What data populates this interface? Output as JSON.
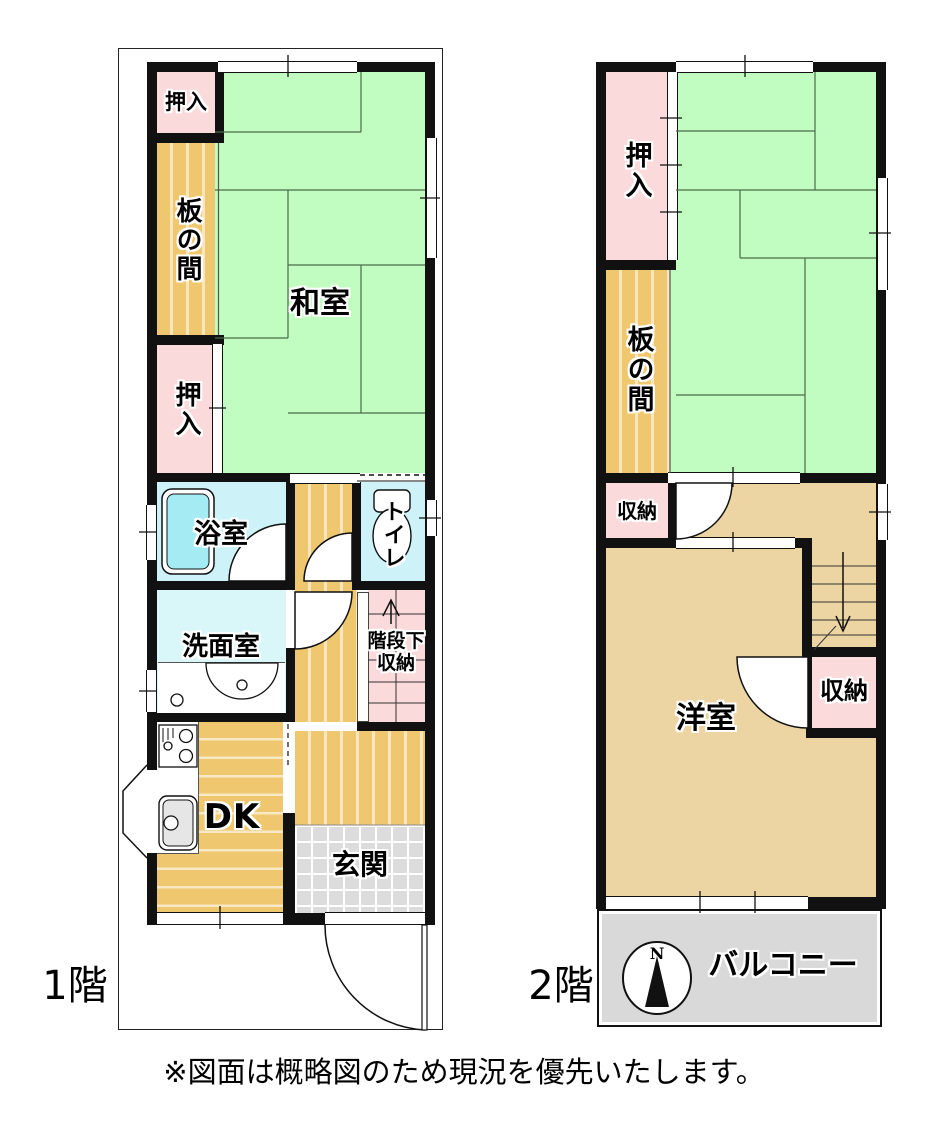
{
  "floor1": {
    "floor_label": "1階",
    "rooms": {
      "oshiire_top": "押入",
      "itanoma": "板の間",
      "washitsu": "和室",
      "oshiire_mid": "押入",
      "bathroom": "浴室",
      "toilet": "トイレ",
      "washroom": "洗面室",
      "understair_line1": "階段下",
      "understair_line2": "収納",
      "dk": "DK",
      "genkan": "玄関"
    }
  },
  "floor2": {
    "floor_label": "2階",
    "rooms": {
      "oshiire": "押入",
      "itanoma": "板の間",
      "storage_left": "収納",
      "storage_right": "収納",
      "youshitsu": "洋室",
      "balcony": "バルコニー"
    },
    "compass_north": "N"
  },
  "footnote": "※図面は概略図のため現況を優先いたします。",
  "colors": {
    "wall": "#111111",
    "tatami": "#c1fcc1",
    "tatami_line": "#4a6b4a",
    "wood": "#eec76e",
    "wood_light": "#ecd5a3",
    "closet_pink": "#fadada",
    "bath_cyan": "#cdf2f7",
    "washroom_cyan": "#d9f7f9",
    "bathtub_cyan": "#a5ebf3",
    "tile_gray": "#dcdcdc",
    "balcony_gray": "#d9d9d9"
  }
}
